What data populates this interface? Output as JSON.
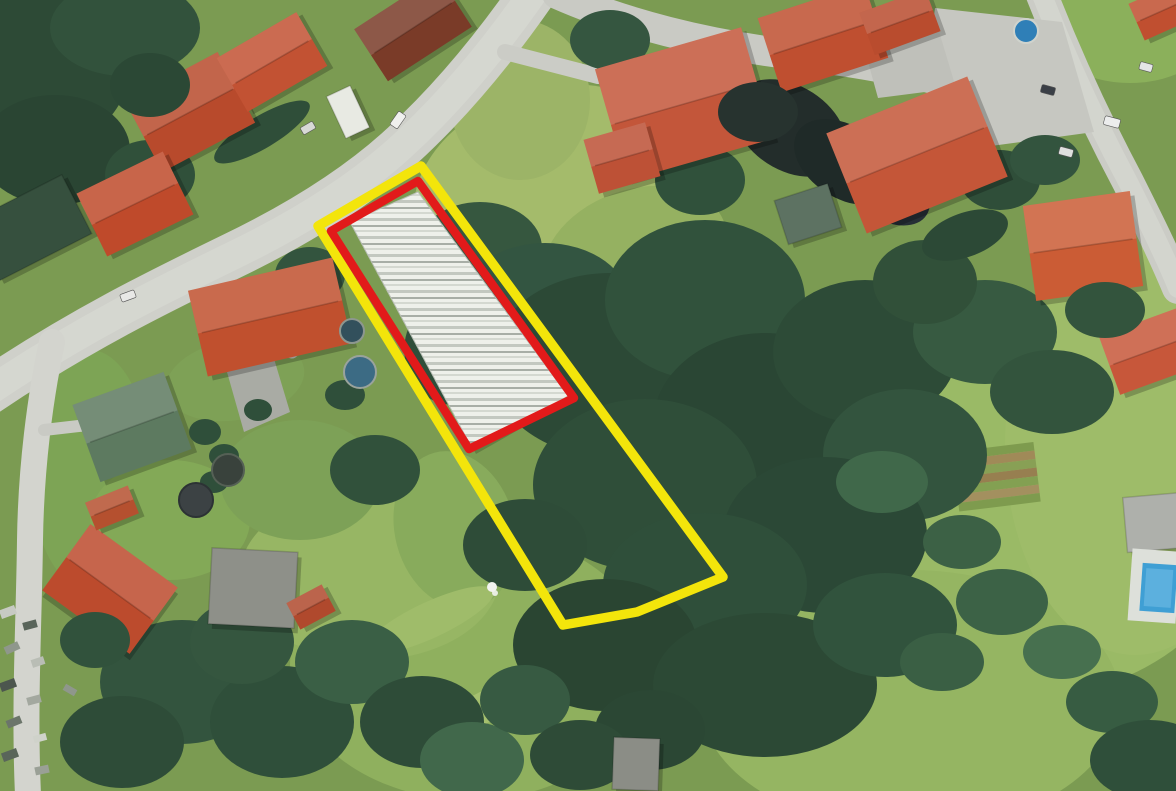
{
  "meta": {
    "kind": "aerial-satellite-photo-with-parcel-overlays",
    "width": 1176,
    "height": 791
  },
  "overlays": {
    "outer": {
      "label": "outer-parcel-boundary",
      "color": "#f3e50b",
      "stroke_width": 9.5,
      "closed": true,
      "points": [
        [
          318,
          226
        ],
        [
          421,
          166
        ],
        [
          723,
          577
        ],
        [
          637,
          612
        ],
        [
          563,
          625
        ]
      ]
    },
    "inner": {
      "label": "inner-parcel-boundary",
      "color": "#e21a1a",
      "stroke_width": 8.5,
      "closed": true,
      "points": [
        [
          331,
          231
        ],
        [
          418,
          181
        ],
        [
          574,
          398
        ],
        [
          469,
          449
        ]
      ]
    }
  },
  "scene": {
    "base_color": "#7b9b52",
    "grass": [
      [
        545,
        185,
        135,
        95,
        -20,
        "#a4bb6b"
      ],
      [
        635,
        255,
        95,
        65,
        -20,
        "#95b161"
      ],
      [
        1010,
        530,
        230,
        170,
        0,
        "#9aba66"
      ],
      [
        910,
        700,
        210,
        130,
        0,
        "#95b562"
      ],
      [
        1135,
        445,
        130,
        210,
        0,
        "#9ebc69"
      ],
      [
        470,
        665,
        180,
        135,
        0,
        "#8fb05e"
      ],
      [
        370,
        575,
        130,
        85,
        0,
        "#97b664"
      ],
      [
        1130,
        28,
        85,
        55,
        0,
        "#8bb05b"
      ],
      [
        90,
        470,
        60,
        120,
        0,
        "#7da455"
      ],
      [
        170,
        520,
        80,
        60,
        0,
        "#83a957"
      ],
      [
        520,
        100,
        70,
        80,
        0,
        "#9cb467"
      ],
      [
        235,
        380,
        70,
        40,
        -10,
        "#7ea156"
      ],
      [
        455,
        530,
        60,
        80,
        -15,
        "#88ab5c"
      ],
      [
        300,
        480,
        80,
        60,
        0,
        "#7da157"
      ],
      [
        430,
        620,
        70,
        18,
        -25,
        "#9fbc6a"
      ],
      [
        500,
        700,
        80,
        16,
        -25,
        "#a5c06f"
      ]
    ],
    "roads": [
      {
        "d": "M 535,-10 C 492,52 448,104 402,146 C 352,192 290,228 232,256 C 160,291 80,330 -12,392",
        "w": 46,
        "color": "#cfd0ca",
        "center": true
      },
      {
        "d": "M 557,-6 C 625,24 706,44 788,54 C 866,63 936,76 998,98",
        "w": 30,
        "color": "#c9cac4",
        "center": false
      },
      {
        "d": "M 1040,-10 C 1064,52 1094,118 1128,182 C 1148,222 1163,252 1178,288",
        "w": 32,
        "color": "#cbccc6",
        "center": true
      },
      {
        "d": "M 52,342 C 40,398 31,468 30,540 C 29,622 24,706 28,795",
        "w": 26,
        "color": "#d3d4ce",
        "center": false
      },
      {
        "d": "M 505,52 L 598,76",
        "w": 16,
        "color": "#cbccc6",
        "center": false
      },
      {
        "d": "M 240,336 L 292,352",
        "w": 13,
        "color": "#c4c5bf",
        "center": false
      },
      {
        "d": "M 44,430 L 96,424",
        "w": 12,
        "color": "#c9cac4",
        "center": false
      }
    ],
    "paved": [
      {
        "points": "935,8 1062,22 1094,132 976,148 928,62",
        "color": "#c6c7c1"
      },
      {
        "points": "862,40 938,28 956,88 878,98",
        "color": "#bfc0ba"
      },
      {
        "points": "227,372 272,352 290,412 244,432",
        "color": "#a9aba4"
      }
    ],
    "clutter": [
      [
        8,
        612,
        16,
        9,
        -20,
        "#c7cac3"
      ],
      [
        30,
        625,
        14,
        8,
        -15,
        "#59655a"
      ],
      [
        12,
        648,
        15,
        8,
        -25,
        "#8f978c"
      ],
      [
        38,
        662,
        13,
        8,
        -18,
        "#b9bdb5"
      ],
      [
        8,
        685,
        16,
        9,
        -20,
        "#4c564e"
      ],
      [
        34,
        700,
        14,
        8,
        -15,
        "#a3a89f"
      ],
      [
        14,
        722,
        15,
        8,
        -22,
        "#6b756a"
      ],
      [
        40,
        738,
        13,
        7,
        -15,
        "#cfd2ca"
      ],
      [
        10,
        755,
        16,
        9,
        -20,
        "#59655a"
      ],
      [
        42,
        770,
        14,
        8,
        -12,
        "#9aa096"
      ],
      [
        70,
        690,
        13,
        7,
        30,
        "#8f978c"
      ],
      [
        75,
        650,
        12,
        7,
        25,
        "#c0c4bc"
      ]
    ],
    "garden": {
      "x": 952,
      "y": 452,
      "w": 82,
      "h": 60,
      "rot": -7,
      "stripes": [
        "#7e9b4e",
        "#a08a58",
        "#88a055",
        "#977f50",
        "#83a052",
        "#a3905f",
        "#7e9b4e"
      ]
    },
    "forest": [
      [
        35,
        65,
        95,
        85,
        0,
        "#2d4a36"
      ],
      [
        125,
        28,
        75,
        48,
        0,
        "#32523c"
      ],
      [
        55,
        150,
        75,
        55,
        0,
        "#2a4533"
      ],
      [
        150,
        175,
        45,
        35,
        0,
        "#30503a"
      ],
      [
        262,
        132,
        55,
        16,
        -31,
        "#2f4e39"
      ],
      [
        480,
        248,
        62,
        46,
        0,
        "#36573f"
      ],
      [
        545,
        305,
        85,
        62,
        0,
        "#335541"
      ],
      [
        610,
        365,
        120,
        92,
        0,
        "#2c4936"
      ],
      [
        705,
        300,
        100,
        80,
        0,
        "#31523c"
      ],
      [
        765,
        425,
        112,
        92,
        0,
        "#2a4634"
      ],
      [
        645,
        485,
        112,
        86,
        0,
        "#2f4e39"
      ],
      [
        865,
        352,
        92,
        72,
        0,
        "#2d4b37"
      ],
      [
        905,
        455,
        82,
        66,
        0,
        "#33543e"
      ],
      [
        825,
        535,
        102,
        78,
        0,
        "#2b4836"
      ],
      [
        705,
        585,
        102,
        72,
        0,
        "#2f4f3a"
      ],
      [
        605,
        645,
        92,
        66,
        0,
        "#2a4532"
      ],
      [
        765,
        685,
        112,
        72,
        0,
        "#2c4935"
      ],
      [
        885,
        625,
        72,
        52,
        0,
        "#31533d"
      ],
      [
        525,
        545,
        62,
        46,
        0,
        "#2e4c38"
      ],
      [
        790,
        128,
        62,
        42,
        33,
        "#232d2b"
      ],
      [
        845,
        162,
        56,
        36,
        33,
        "#1f2a28"
      ],
      [
        888,
        190,
        46,
        30,
        33,
        "#262f36"
      ],
      [
        985,
        332,
        72,
        52,
        0,
        "#375a41"
      ],
      [
        1052,
        392,
        62,
        42,
        0,
        "#33543d"
      ],
      [
        925,
        282,
        52,
        42,
        0,
        "#315039"
      ],
      [
        1002,
        602,
        46,
        33,
        0,
        "#3c6246"
      ],
      [
        942,
        662,
        42,
        29,
        0,
        "#3a5f44"
      ],
      [
        1062,
        652,
        39,
        27,
        0,
        "#47704f"
      ],
      [
        882,
        482,
        46,
        31,
        0,
        "#40684a"
      ],
      [
        962,
        542,
        39,
        27,
        0,
        "#3c6145"
      ],
      [
        1112,
        702,
        46,
        31,
        0,
        "#375c42"
      ],
      [
        1150,
        760,
        60,
        40,
        0,
        "#2f4f3a"
      ],
      [
        182,
        682,
        82,
        62,
        0,
        "#33543e"
      ],
      [
        282,
        722,
        72,
        56,
        0,
        "#2f4f3a"
      ],
      [
        122,
        742,
        62,
        46,
        0,
        "#2e4c38"
      ],
      [
        352,
        662,
        57,
        42,
        0,
        "#3a5f45"
      ],
      [
        422,
        722,
        62,
        46,
        0,
        "#2e4c38"
      ],
      [
        242,
        642,
        52,
        42,
        0,
        "#35563f"
      ],
      [
        472,
        760,
        52,
        38,
        0,
        "#41684b"
      ],
      [
        525,
        700,
        45,
        35,
        0,
        "#375a42"
      ],
      [
        650,
        730,
        55,
        40,
        0,
        "#2b4734"
      ],
      [
        580,
        755,
        50,
        35,
        0,
        "#2e4b37"
      ],
      [
        310,
        275,
        35,
        28,
        0,
        "#33543e"
      ],
      [
        375,
        470,
        45,
        35,
        0,
        "#31513b"
      ],
      [
        1000,
        180,
        40,
        30,
        0,
        "#2f4e39"
      ],
      [
        1045,
        160,
        35,
        25,
        0,
        "#33543e"
      ],
      [
        700,
        180,
        45,
        35,
        0,
        "#30513b"
      ],
      [
        610,
        40,
        40,
        30,
        0,
        "#355640"
      ],
      [
        965,
        235,
        45,
        22,
        -20,
        "#2c4936"
      ],
      [
        445,
        355,
        40,
        50,
        -15,
        "#2f4e3a"
      ]
    ],
    "buildings": [
      {
        "cx": 190,
        "cy": 112,
        "w": 105,
        "h": 80,
        "rot": -28,
        "color": "#b84a2c",
        "kind": "house",
        "style": "gable"
      },
      {
        "cx": 272,
        "cy": 62,
        "w": 92,
        "h": 62,
        "rot": -30,
        "color": "#c25233",
        "kind": "house",
        "style": "gable"
      },
      {
        "cx": 135,
        "cy": 204,
        "w": 96,
        "h": 70,
        "rot": -26,
        "color": "#bf4a2b",
        "kind": "house",
        "style": "gable"
      },
      {
        "cx": 30,
        "cy": 228,
        "w": 105,
        "h": 66,
        "rot": -27,
        "color": "#36503e",
        "kind": "dark-building",
        "style": "flat"
      },
      {
        "cx": 270,
        "cy": 317,
        "w": 148,
        "h": 88,
        "rot": -13,
        "color": "#c0502e",
        "kind": "house",
        "style": "gable"
      },
      {
        "cx": 132,
        "cy": 427,
        "w": 97,
        "h": 82,
        "rot": -20,
        "color": "#5d7a60",
        "kind": "green-roof-house",
        "style": "gable"
      },
      {
        "cx": 684,
        "cy": 104,
        "w": 152,
        "h": 116,
        "rot": -16,
        "color": "#c3563a",
        "kind": "house",
        "style": "gable"
      },
      {
        "cx": 622,
        "cy": 158,
        "w": 64,
        "h": 56,
        "rot": -16,
        "color": "#bd5136",
        "kind": "house-wing",
        "style": "gable"
      },
      {
        "cx": 823,
        "cy": 38,
        "w": 112,
        "h": 78,
        "rot": -18,
        "color": "#bf4f30",
        "kind": "house",
        "style": "gable"
      },
      {
        "cx": 917,
        "cy": 155,
        "w": 152,
        "h": 108,
        "rot": -22,
        "color": "#c45638",
        "kind": "house",
        "style": "gable"
      },
      {
        "cx": 1083,
        "cy": 246,
        "w": 108,
        "h": 96,
        "rot": -8,
        "color": "#cb5c35",
        "kind": "villa",
        "style": "gable"
      },
      {
        "cx": 1150,
        "cy": 351,
        "w": 86,
        "h": 62,
        "rot": -20,
        "color": "#c7573a",
        "kind": "house",
        "style": "gable"
      },
      {
        "cx": 900,
        "cy": 22,
        "w": 70,
        "h": 45,
        "rot": -20,
        "color": "#b94c2e",
        "kind": "house",
        "style": "gable"
      },
      {
        "cx": 1164,
        "cy": 10,
        "w": 60,
        "h": 40,
        "rot": -24,
        "color": "#c04f30",
        "kind": "house",
        "style": "gable"
      },
      {
        "cx": 110,
        "cy": 589,
        "w": 108,
        "h": 82,
        "rot": 36,
        "color": "#bc4b2d",
        "kind": "house",
        "style": "gable"
      },
      {
        "cx": 253,
        "cy": 588,
        "w": 86,
        "h": 76,
        "rot": 3,
        "color": "#8e9089",
        "kind": "flat-building",
        "style": "flat"
      },
      {
        "cx": 311,
        "cy": 607,
        "w": 40,
        "h": 30,
        "rot": -28,
        "color": "#b0492d",
        "kind": "shed",
        "style": "gable"
      },
      {
        "cx": 636,
        "cy": 764,
        "w": 46,
        "h": 52,
        "rot": 2,
        "color": "#8b8d86",
        "kind": "shed",
        "style": "flat"
      },
      {
        "cx": 808,
        "cy": 214,
        "w": 56,
        "h": 46,
        "rot": -18,
        "color": "#5d7262",
        "kind": "green-structure",
        "style": "flat"
      },
      {
        "cx": 413,
        "cy": 28,
        "w": 100,
        "h": 62,
        "rot": -33,
        "color": "#7a3b28",
        "kind": "dark-roof-house",
        "style": "gable"
      },
      {
        "cx": 1160,
        "cy": 522,
        "w": 70,
        "h": 55,
        "rot": -5,
        "color": "#aeb0ab",
        "kind": "pool-house",
        "style": "flat"
      },
      {
        "cx": 348,
        "cy": 112,
        "w": 26,
        "h": 46,
        "rot": -25,
        "color": "#e8eae3",
        "kind": "tent",
        "style": "flat"
      },
      {
        "cx": 112,
        "cy": 508,
        "w": 46,
        "h": 30,
        "rot": -22,
        "color": "#b5502f",
        "kind": "house",
        "style": "gable"
      }
    ],
    "bushes": [
      [
        205,
        432,
        16,
        13,
        "#2f4f3a"
      ],
      [
        224,
        456,
        15,
        12,
        "#2f4f3a"
      ],
      [
        214,
        482,
        14,
        11,
        "#2f4f3a"
      ],
      [
        345,
        395,
        20,
        15,
        "#2f4f3a"
      ],
      [
        258,
        410,
        14,
        11,
        "#2f4f3a"
      ]
    ],
    "canopy": [
      [
        150,
        85,
        40,
        32,
        0,
        "#2b4835"
      ],
      [
        758,
        112,
        40,
        30,
        0,
        "#27332f"
      ],
      [
        1105,
        310,
        40,
        28,
        0,
        "#33543d"
      ],
      [
        95,
        640,
        35,
        28,
        0,
        "#31523c"
      ]
    ],
    "cars": [
      [
        128,
        296,
        15,
        8,
        -20,
        "#e8e8e6"
      ],
      [
        398,
        120,
        16,
        9,
        -55,
        "#f0f0ee"
      ],
      [
        308,
        128,
        14,
        8,
        -30,
        "#d8d9d5"
      ],
      [
        1048,
        90,
        14,
        8,
        15,
        "#3a3f46"
      ],
      [
        1112,
        122,
        16,
        9,
        15,
        "#eceded"
      ],
      [
        1146,
        67,
        13,
        8,
        15,
        "#e4e6e6"
      ],
      [
        1066,
        152,
        14,
        8,
        15,
        "#dfe0df"
      ]
    ],
    "circles": [
      {
        "cx": 360,
        "cy": 372,
        "r": 16,
        "color": "#3c6b84",
        "ring": "#9aa39c",
        "name": "round-pool"
      },
      {
        "cx": 352,
        "cy": 331,
        "r": 12,
        "color": "#32505c",
        "ring": "#8d978f",
        "name": "round-pool"
      },
      {
        "cx": 228,
        "cy": 470,
        "r": 16,
        "color": "#39423c",
        "ring": "#556055",
        "name": "round-pool"
      },
      {
        "cx": 196,
        "cy": 500,
        "r": 17,
        "color": "#3c4244",
        "ring": "#2c3234",
        "name": "parasol"
      },
      {
        "cx": 1026,
        "cy": 31,
        "r": 12,
        "color": "#2f7fb7",
        "ring": "#cfd3cd",
        "name": "small-pool"
      }
    ],
    "pool": {
      "deck": [
        1130,
        550,
        48,
        72,
        4,
        "#dde0da"
      ],
      "water": [
        1141,
        564,
        35,
        48,
        4,
        "#3f9fd4"
      ],
      "water_light": "#6ab8e2"
    },
    "greenhouse": {
      "points": [
        [
          350,
          222
        ],
        [
          418,
          192
        ],
        [
          568,
          396
        ],
        [
          473,
          450
        ]
      ],
      "bg": "#eef0ea",
      "row_colors": [
        "#c3c8c0",
        "#a8aea6",
        "#d4d8d0"
      ]
    },
    "figure": {
      "cx": 492,
      "cy": 587,
      "color": "#f2f3ef"
    }
  }
}
